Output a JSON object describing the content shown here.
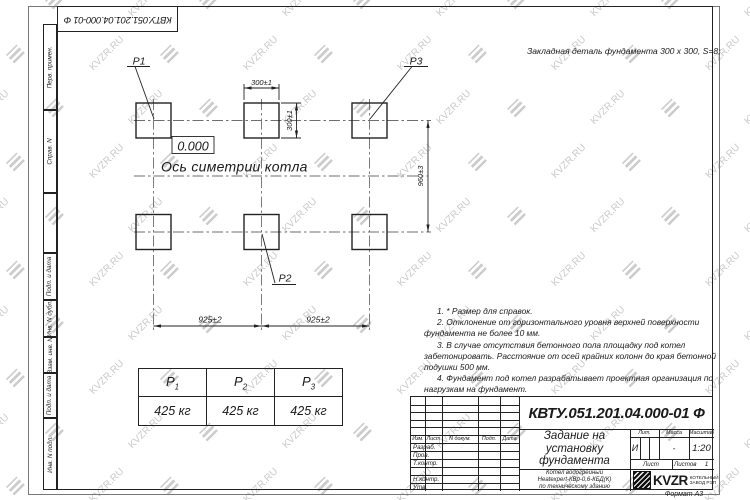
{
  "watermark": {
    "text": "KVZR.RU"
  },
  "colors": {
    "line": "#222222",
    "watermark": "#c9c9c9"
  },
  "stamp_top_left": "КВТУ.051.201.04.000-01 Ф",
  "side_strip": {
    "labels": [
      "Перв. примен.",
      "Справ. N",
      "Подп. и дата",
      "Инв. N дубл.",
      "Взам. инв. N",
      "Подп. и дата",
      "Инв. N подл."
    ]
  },
  "header_note": "Закладная деталь фундамента  300 x 300,  S=8;",
  "plan": {
    "label_p1": "P1",
    "label_p2": "P2",
    "label_p3": "P3",
    "elevation": "0.000",
    "axis_label": "Ось симетрии котла",
    "dim_pad_width": "300±1",
    "dim_pad_height": "300±1",
    "dim_row_spacing": "960±3",
    "dim_col_left": "925±2",
    "dim_col_right": "925±2"
  },
  "notes": [
    "1. * Размер для справок.",
    "2. Отклонение от горизонтального уровня верхней поверхности фундамента не более 10 мм.",
    "3. В случае отсутствия бетонного пола площадку под котел забетонировать. Расстояние от осей крайних колонн до края бетонной подушки 500 мм.",
    "4. Фундамент под котел разрабатывает проектная организация по нагрузкам на фундамент."
  ],
  "load_table": {
    "headers": [
      {
        "label": "P",
        "sub": "1"
      },
      {
        "label": "P",
        "sub": "2"
      },
      {
        "label": "P",
        "sub": "3"
      }
    ],
    "values": [
      "425 кг",
      "425 кг",
      "425 кг"
    ]
  },
  "title_block": {
    "doc_number": "КВТУ.051.201.04.000-01 Ф",
    "title": "Задание на\nустановку\nфундамента",
    "product": "Котел водогрейный\nHeatexpert-КВр-0,6-КБД(К)\nпо техническому зданию",
    "header_cols": [
      "Изм.",
      "Лист",
      "N докум.",
      "Подп.",
      "Дата"
    ],
    "row_labels": [
      "Разраб.",
      "Пров.",
      "Т.контр.",
      "Н.контр.",
      "Утв."
    ],
    "lit_label": "Лит.",
    "lit_value": "И",
    "mass_label": "Масса",
    "mass_value": "-",
    "scale_label": "Масштаб",
    "scale_value": "1:20",
    "sheet_label": "Лист",
    "sheets_label": "Листов",
    "sheets_value": "1",
    "company": {
      "logo_text": "KVZR",
      "name": "КОТЕЛЬНЫЙ\nЗАВОД РЭП"
    },
    "format": "Формат А3"
  }
}
